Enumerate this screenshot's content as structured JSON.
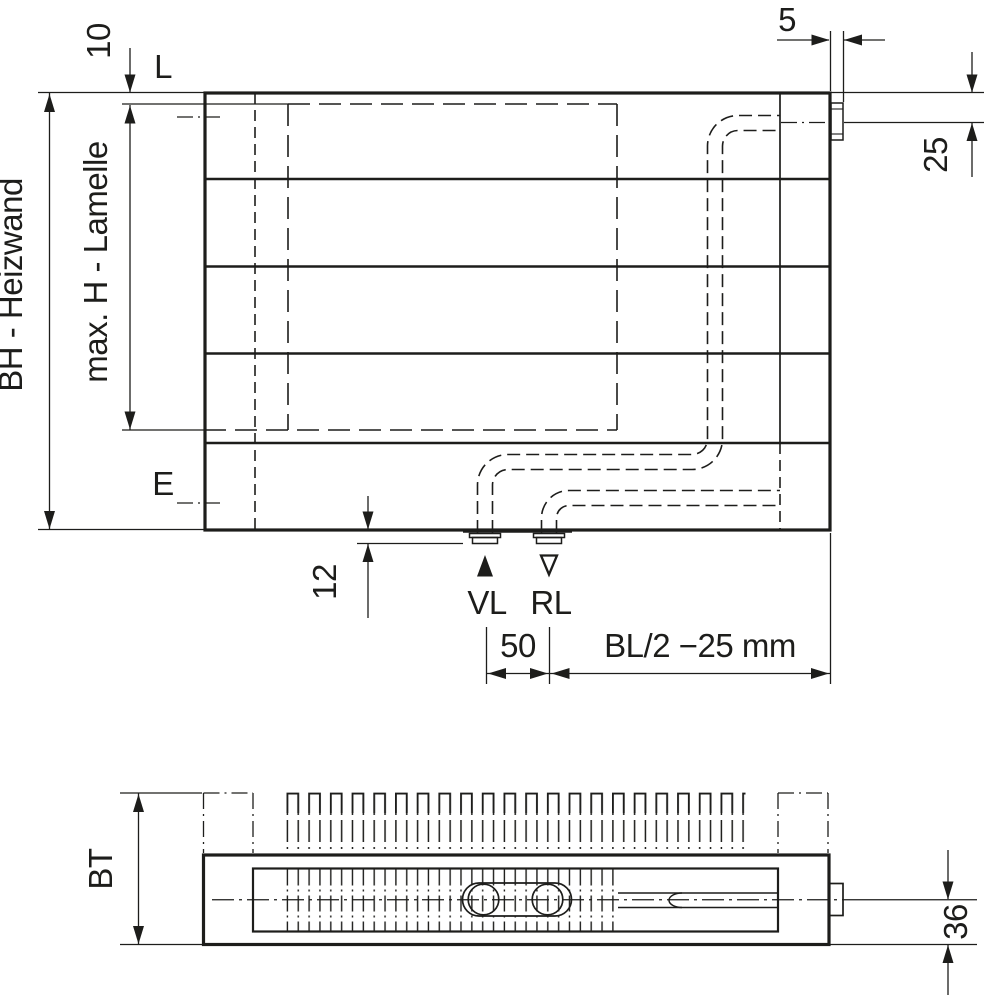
{
  "drawing": {
    "type": "technical-dimension-drawing",
    "views": [
      "front elevation",
      "plan view"
    ],
    "colors": {
      "line": "#1d1d1b",
      "background": "#ffffff"
    }
  },
  "front_view": {
    "dim_total_height": "BH - Heizwand",
    "dim_lamella_height": "max. H - Lamelle",
    "dim_top_offset": "10",
    "label_top_level": "L",
    "label_bottom_level": "E",
    "dim_side_gap": "5",
    "dim_connection_from_top": "25",
    "dim_bottom_offset": "12",
    "supply_label": "VL",
    "return_label": "RL",
    "dim_connection_spacing": "50",
    "dim_connection_position": "BL/2 −25 mm"
  },
  "top_view": {
    "dim_build_depth": "BT",
    "dim_pipe_axis": "36"
  }
}
